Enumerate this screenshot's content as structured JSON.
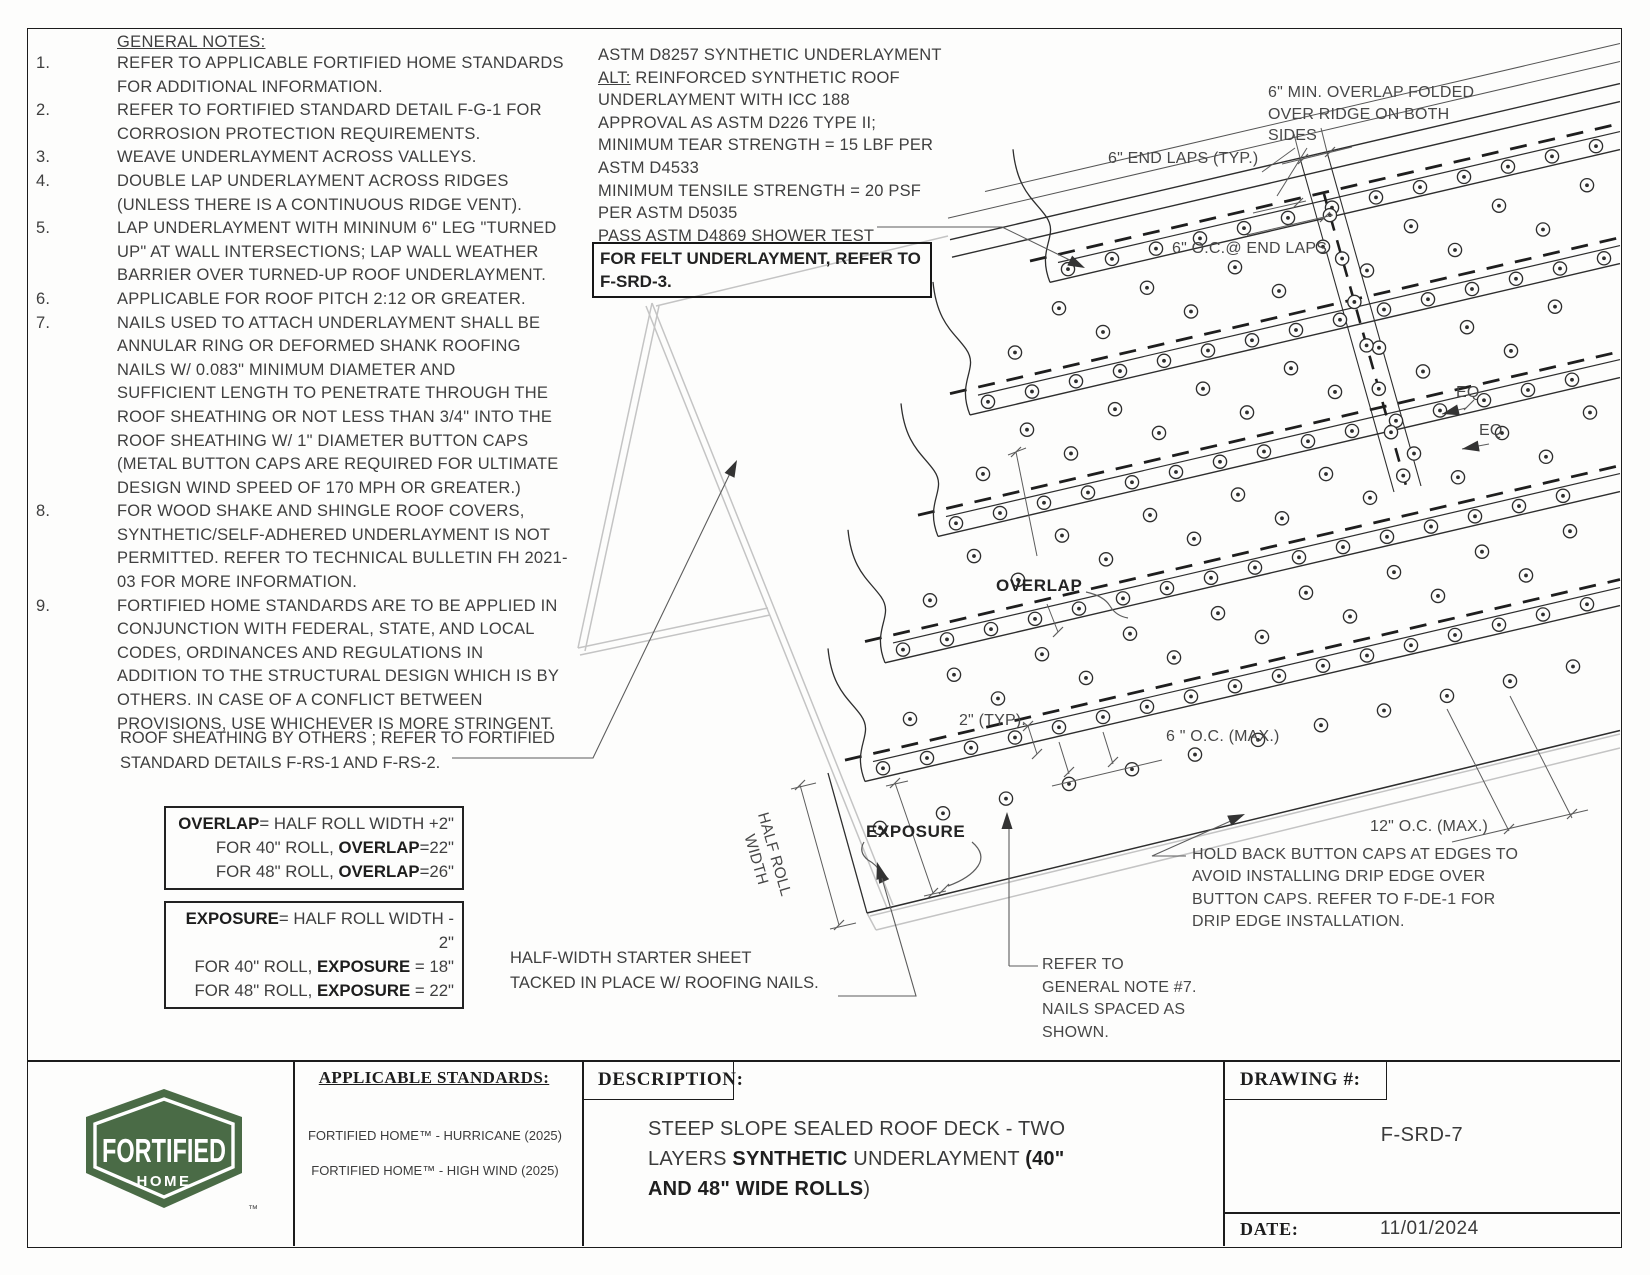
{
  "general_notes": {
    "heading": "GENERAL NOTES:",
    "items": [
      {
        "num": "1.",
        "text": "REFER TO APPLICABLE FORTIFIED HOME STANDARDS\nFOR ADDITIONAL INFORMATION."
      },
      {
        "num": "2.",
        "text": "REFER TO FORTIFIED STANDARD DETAIL F-G-1 FOR\nCORROSION PROTECTION REQUIREMENTS."
      },
      {
        "num": "3.",
        "text": "WEAVE UNDERLAYMENT ACROSS VALLEYS."
      },
      {
        "num": "4.",
        "text": "DOUBLE LAP UNDERLAYMENT ACROSS RIDGES\n(UNLESS THERE IS A CONTINUOUS RIDGE VENT)."
      },
      {
        "num": "5.",
        "text": "LAP UNDERLAYMENT WITH MININUM 6\" LEG \"TURNED\nUP\" AT WALL INTERSECTIONS; LAP WALL WEATHER\nBARRIER OVER TURNED-UP ROOF UNDERLAYMENT."
      },
      {
        "num": "6.",
        "text": "APPLICABLE FOR ROOF PITCH 2:12 OR GREATER."
      },
      {
        "num": "7.",
        "text": "NAILS USED TO ATTACH UNDERLAYMENT SHALL BE\nANNULAR RING OR DEFORMED SHANK ROOFING\nNAILS W/ 0.083\" MINIMUM DIAMETER AND\nSUFFICIENT LENGTH TO PENETRATE THROUGH THE\nROOF SHEATHING OR NOT LESS THAN 3/4\" INTO THE\nROOF SHEATHING W/ 1\" DIAMETER BUTTON CAPS\n(METAL BUTTON CAPS ARE REQUIRED FOR ULTIMATE\nDESIGN WIND SPEED OF 170 MPH OR GREATER.)"
      },
      {
        "num": "8.",
        "text": "FOR WOOD SHAKE AND SHINGLE ROOF COVERS,\nSYNTHETIC/SELF-ADHERED UNDERLAYMENT IS NOT\nPERMITTED. REFER TO TECHNICAL BULLETIN FH 2021-\n03 FOR MORE INFORMATION."
      },
      {
        "num": "9.",
        "text": "FORTIFIED HOME STANDARDS ARE TO BE APPLIED IN\nCONJUNCTION WITH FEDERAL, STATE, AND LOCAL\nCODES, ORDINANCES AND REGULATIONS IN\nADDITION TO THE STRUCTURAL DESIGN WHICH IS BY\nOTHERS. IN CASE OF A CONFLICT BETWEEN\nPROVISIONS, USE WHICHEVER IS MORE STRINGENT."
      }
    ]
  },
  "sheathing_note": "ROOF SHEATHING BY OTHERS ; REFER TO FORTIFIED\nSTANDARD DETAILS F-RS-1 AND F-RS-2.",
  "astm": {
    "line1": "ASTM D8257 SYNTHETIC UNDERLAYMENT",
    "alt_label": "ALT:",
    "alt_rest": " REINFORCED SYNTHETIC ROOF",
    "rest": "UNDERLAYMENT WITH ICC 188\nAPPROVAL AS ASTM D226 TYPE II;\nMINIMUM TEAR STRENGTH = 15 LBF PER\nASTM D4533\nMINIMUM TENSILE STRENGTH = 20 PSF\nPER ASTM D5035\nPASS ASTM D4869 SHOWER TEST"
  },
  "felt_note": {
    "line1": "FOR FELT UNDERLAYMENT, REFER TO",
    "line2": "F-SRD-3."
  },
  "overlap_box": {
    "l1b": "OVERLAP",
    "l1r": "= HALF ROLL WIDTH +2\"",
    "l2a": "FOR 40\" ROLL, ",
    "l2b": "OVERLAP",
    "l2c": "=22\"",
    "l3a": "FOR 48\" ROLL, ",
    "l3b": "OVERLAP",
    "l3c": "=26\""
  },
  "exposure_box": {
    "l1b": "EXPOSURE",
    "l1r": "= HALF ROLL WIDTH - 2\"",
    "l2a": "FOR 40\" ROLL, ",
    "l2b": "EXPOSURE",
    "l2c": " = 18\"",
    "l3a": "FOR 48\" ROLL, ",
    "l3b": "EXPOSURE",
    "l3c": " = 22\""
  },
  "starter_note": "HALF-WIDTH STARTER SHEET\nTACKED IN PLACE W/ ROOFING NAILS.",
  "annotations": {
    "ridge_overlap": "6\" MIN. OVERLAP FOLDED\nOVER RIDGE ON BOTH\nSIDES",
    "end_laps": "6\" END LAPS (TYP.)",
    "oc_end_laps": "6\" O.C.@ END LAPS",
    "eq1": "EQ",
    "eq2": "EQ",
    "overlap_label": "OVERLAP",
    "exposure_label": "EXPOSURE",
    "two_typ": "2\" (TYP).",
    "six_oc": "6 \" O.C. (MAX.)",
    "twelve_oc": "12\" O.C. (MAX.)",
    "half_roll": "HALF ROLL\nWIDTH",
    "note7": "REFER TO\nGENERAL NOTE #7.\nNAILS SPACED AS\nSHOWN.",
    "hold_back": "HOLD BACK BUTTON CAPS AT EDGES TO\nAVOID INSTALLING DRIP EDGE OVER\nBUTTON CAPS. REFER TO F-DE-1 FOR\nDRIP EDGE INSTALLATION."
  },
  "title_block": {
    "logo": {
      "line1": "FORTIFIED",
      "line2": "HOME",
      "tm": "™",
      "color": "#4a6b46"
    },
    "standards": {
      "heading": "APPLICABLE STANDARDS:",
      "items": [
        "FORTIFIED HOME™ - HURRICANE (2025)",
        "FORTIFIED HOME™ - HIGH WIND (2025)"
      ]
    },
    "description": {
      "label": "DESCRIPTION:",
      "seg1": "STEEP SLOPE SEALED ROOF DECK - TWO",
      "seg2a": "LAYERS ",
      "seg2b": "SYNTHETIC",
      "seg2c": " UNDERLAYMENT ",
      "seg2d": "(40\"",
      "seg3a": "AND 48\" WIDE ROLLS",
      "seg3b": ")"
    },
    "drawing": {
      "label": "DRAWING #:",
      "number": "F-SRD-7"
    },
    "date": {
      "label": "DATE:",
      "value": "11/01/2024"
    }
  }
}
